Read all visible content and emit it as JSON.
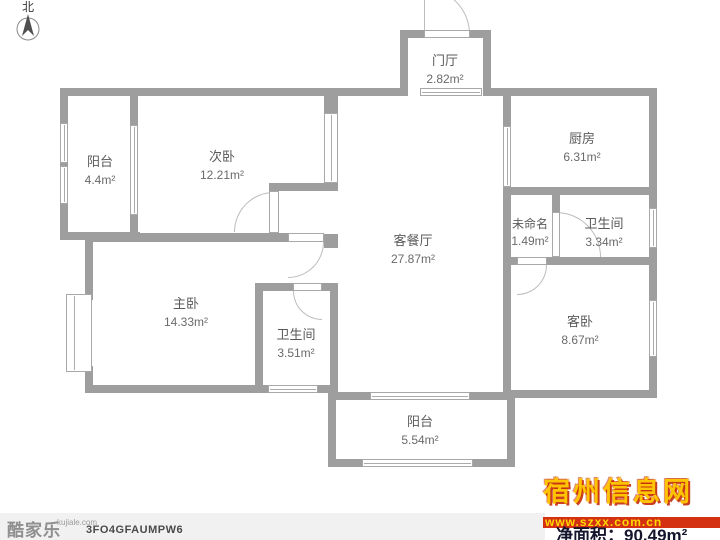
{
  "compass": {
    "label": "北"
  },
  "rooms": [
    {
      "name": "门厅",
      "area": "2.82m²"
    },
    {
      "name": "厨房",
      "area": "6.31m²"
    },
    {
      "name": "阳台",
      "area": "4.4m²"
    },
    {
      "name": "次卧",
      "area": "12.21m²"
    },
    {
      "name": "客餐厅",
      "area": "27.87m²"
    },
    {
      "name": "未命名",
      "area": "1.49m²"
    },
    {
      "name": "卫生间",
      "area": "3.34m²"
    },
    {
      "name": "主卧",
      "area": "14.33m²"
    },
    {
      "name": "卫生间",
      "area": "3.51m²"
    },
    {
      "name": "客卧",
      "area": "8.67m²"
    },
    {
      "name": "阳台",
      "area": "5.54m²"
    }
  ],
  "footer": {
    "logo_text": "酷家乐",
    "logo_domain": "kujiale.com",
    "plan_code": "3FO4GFAUMPW6"
  },
  "watermark": {
    "site_name": "宿州信息网",
    "site_url": "www.szxx.com.cn",
    "net_area": "净面积：90.49m²",
    "gold_color": "#ffc400",
    "red_color": "#d43113"
  },
  "colors": {
    "wall": "#9e9e9e",
    "label_text": "#5a5a5a"
  }
}
